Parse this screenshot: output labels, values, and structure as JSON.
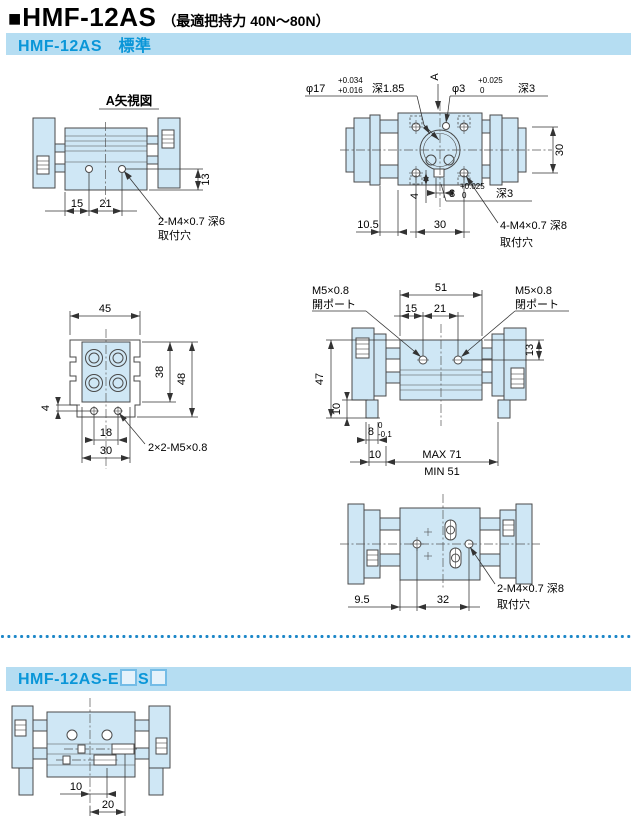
{
  "page": {
    "bullet": "■",
    "title": "HMF-12AS",
    "title_note": "（最適把持力 40N～80N）"
  },
  "sections": {
    "standard": {
      "header": "HMF-12AS　標準"
    },
    "sensor": {
      "header_prefix": "HMF-12AS-E",
      "header_mid": "S"
    }
  },
  "colors": {
    "accent_blue": "#0a96d8",
    "bar_background": "#b5ddf2",
    "drawing_fill": "#cfe7f5",
    "line": "#4a4a4a",
    "dots": "#1d87c8"
  },
  "views": {
    "view_a": {
      "title": "A矢視図",
      "dim_15": "15",
      "dim_21": "21",
      "dim_13": "13",
      "note_line1": "2-M4×0.7 深6",
      "note_line2": "取付穴"
    },
    "top_view": {
      "phi17": "φ17",
      "phi17_tol_upper": "+0.034",
      "phi17_tol_lower": "+0.016",
      "phi17_depth": "深1.85",
      "arrow_label": "A",
      "phi3": "φ3",
      "phi3_tol_upper": "+0.025",
      "phi3_tol_lower": "0",
      "phi3_depth": "深3",
      "dim_30_right": "30",
      "dim_4": "4",
      "dim_3": "3",
      "dim_3_tol_upper": "+0.025",
      "dim_3_tol_lower": "0",
      "dim_3_depth": "深3",
      "dim_10_5": "10.5",
      "dim_30_bottom": "30",
      "note_line1": "4-M4×0.7 深8",
      "note_line2": "取付穴"
    },
    "end_view": {
      "dim_45": "45",
      "dim_38": "38",
      "dim_48": "48",
      "dim_4": "4",
      "dim_18": "18",
      "dim_30": "30",
      "note": "2×2-M5×0.8"
    },
    "side_view": {
      "port_open_line1": "M5×0.8",
      "port_open_line2": "開ポート",
      "port_close_line1": "M5×0.8",
      "port_close_line2": "閉ポート",
      "dim_51": "51",
      "dim_15": "15",
      "dim_21": "21",
      "dim_13": "13",
      "dim_47": "47",
      "dim_10_left": "10",
      "dim_8": "8",
      "dim_8_tol_upper": "0",
      "dim_8_tol_lower": "-0.1",
      "dim_10_bottom": "10",
      "dim_max": "MAX 71",
      "dim_min": "MIN 51"
    },
    "bottom_view": {
      "dim_9_5": "9.5",
      "dim_32": "32",
      "note_line1": "2-M4×0.7 深8",
      "note_line2": "取付穴"
    },
    "sensor_view": {
      "dim_10": "10",
      "dim_20": "20"
    }
  }
}
